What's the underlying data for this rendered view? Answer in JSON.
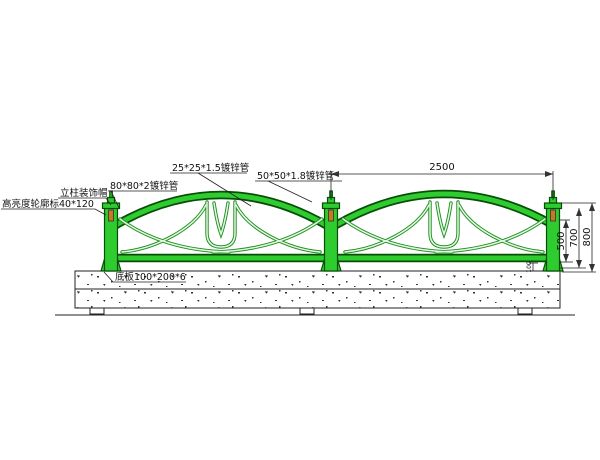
{
  "drawing": {
    "type": "fence-elevation-cad-drawing"
  },
  "colors": {
    "fence_green": "#2ecc2e",
    "fence_outline": "#084d08",
    "tube_green": "#1f8f1f",
    "tube_highlight": "#e4f9e4",
    "reflector_orange": "#c8781e",
    "line_black": "#222222"
  },
  "annotations": {
    "post_cap_label": "立柱装饰帽",
    "reflector_label": "高亮度轮廓标40*120",
    "post_tube_label": "80*80*2镀锌管",
    "infill_tube_label": "25*25*1.5镀锌管",
    "top_rail_tube_label": "50*50*1.8镀锌管",
    "base_plate_label": "底板100*200*6"
  },
  "dimensions": {
    "bay_width": "2500",
    "infill_height": "500",
    "post_height": "700",
    "overall_height": "800",
    "bottom_gap": "100"
  }
}
